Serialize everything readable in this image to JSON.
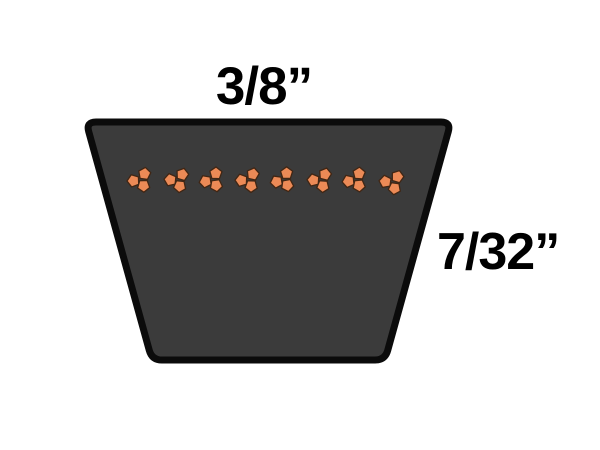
{
  "page": {
    "background": "#ffffff",
    "description": "V-belt cross-section dimension diagram"
  },
  "diagram": {
    "top_width_label": {
      "text": "3/8”",
      "x": 264,
      "y": 104,
      "font_size": 53
    },
    "side_depth_label": {
      "text": "7/32”",
      "x": 437,
      "y": 269,
      "font_size": 52
    },
    "belt": {
      "fill": "#3b3b3b",
      "stroke": "#0b0b0b",
      "stroke_width": 7,
      "corner_radius": 10,
      "corners": [
        [
          86,
          122
        ],
        [
          451,
          122
        ],
        [
          385,
          360
        ],
        [
          152,
          360
        ]
      ]
    },
    "cords": {
      "fill": "#ec8a56",
      "stroke": "#402614",
      "stroke_width": 1.3,
      "pebble_radius": 6.4,
      "row_y": 180,
      "centers_x": [
        140,
        177,
        212,
        248,
        283,
        320,
        355,
        392
      ],
      "y_offsets": [
        0,
        0,
        0,
        0,
        0,
        0,
        0,
        2
      ],
      "cluster_rotations": [
        0,
        8,
        -6,
        4,
        -8,
        6,
        -4,
        10
      ],
      "pebble_offsets": [
        [
          4.5,
          -6.2
        ],
        [
          -6.6,
          0.8
        ],
        [
          3.6,
          5.8
        ]
      ],
      "pebble_rotations": [
        8,
        -20,
        34
      ]
    }
  }
}
